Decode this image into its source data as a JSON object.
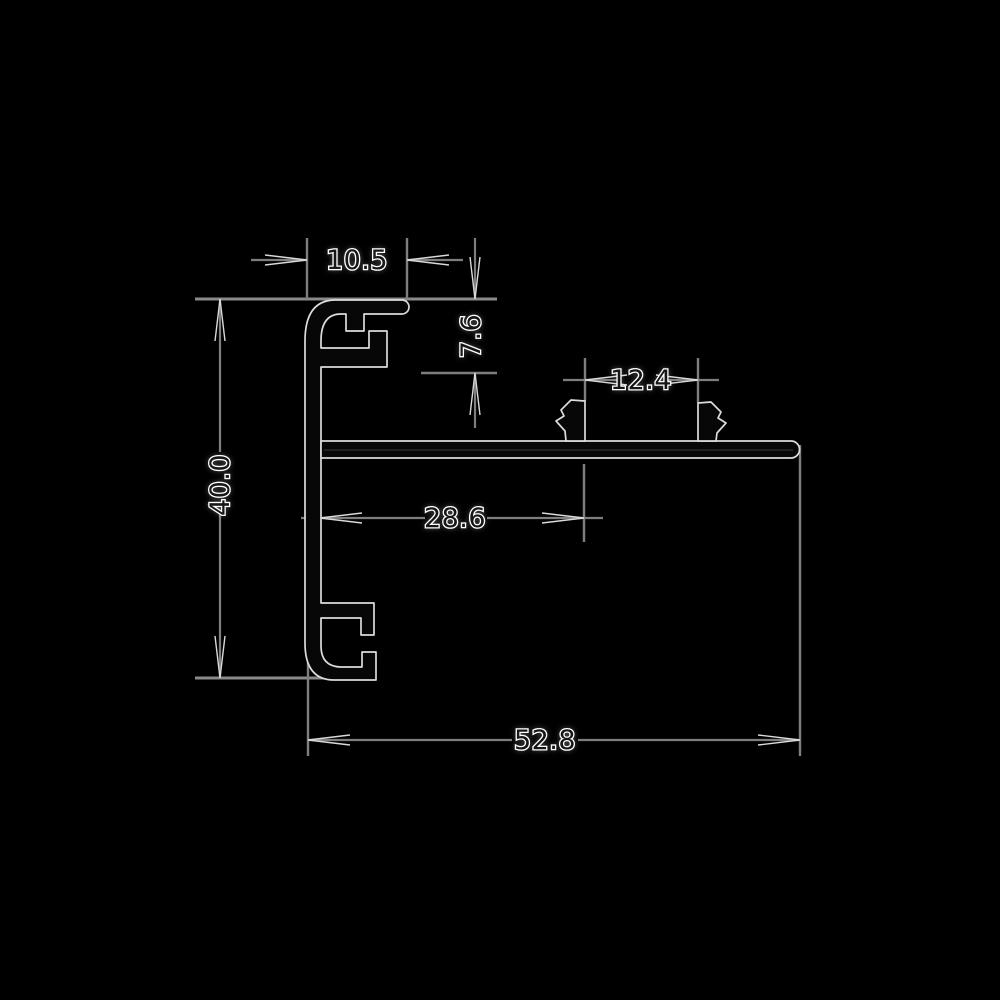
{
  "drawing": {
    "kind": "extrusion-profile-cross-section",
    "background_color": "#000000",
    "dimension_line_color": "#7e7e7e",
    "arrow_color": "#d9d9d9",
    "profile_outline_color": "#dcdcdc",
    "profile_fill_color": "#070707",
    "text_fill_color": "#161616",
    "text_halo_color": "#ffffff",
    "dimensions": {
      "top_flange_width": "10.5",
      "top_channel_height": "7.6",
      "clip_slot_width": "12.4",
      "web_to_slot_offset": "28.6",
      "total_height": "40.0",
      "total_width": "52.8"
    }
  }
}
